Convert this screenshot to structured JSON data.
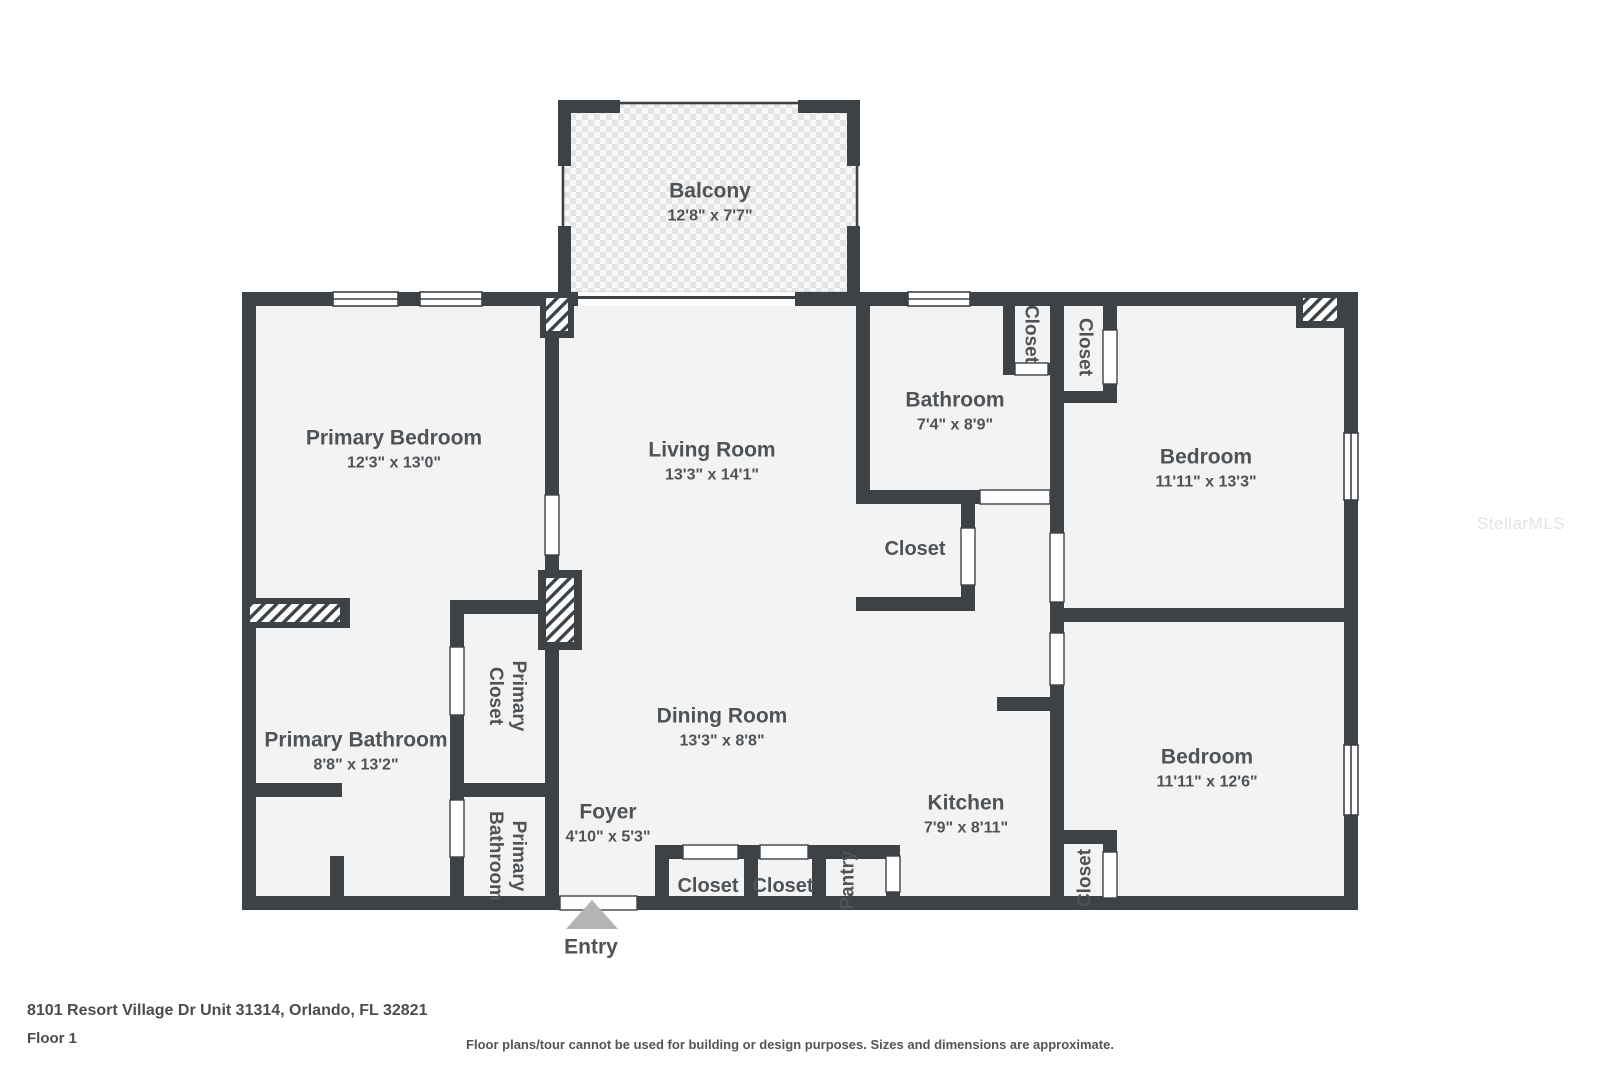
{
  "page": {
    "width": 1600,
    "height": 1066,
    "background": "#ffffff"
  },
  "watermark": "StellarMLS",
  "footer": {
    "address": "8101 Resort Village Dr Unit 31314, Orlando, FL 32821",
    "floor": "Floor 1",
    "disclaimer": "Floor plans/tour cannot be used for building or design purposes. Sizes and dimensions are approximate."
  },
  "colors": {
    "wall": "#3d4247",
    "room_fill": "#f3f3f3",
    "label_text": "#4e5358",
    "entry_marker": "#b4b4b4",
    "balcony_tile": "#e4e4e4",
    "watermark_text": "#e3e3e6"
  },
  "rooms": {
    "balcony": {
      "name": "Balcony",
      "dims": "12'8\" x 7'7\""
    },
    "primary_bedroom": {
      "name": "Primary Bedroom",
      "dims": "12'3\" x 13'0\""
    },
    "living_room": {
      "name": "Living Room",
      "dims": "13'3\" x 14'1\""
    },
    "bathroom": {
      "name": "Bathroom",
      "dims": "7'4\" x 8'9\""
    },
    "bedroom_top": {
      "name": "Bedroom",
      "dims": "11'11\" x 13'3\""
    },
    "bedroom_bottom": {
      "name": "Bedroom",
      "dims": "11'11\" x 12'6\""
    },
    "dining_room": {
      "name": "Dining Room",
      "dims": "13'3\" x 8'8\""
    },
    "primary_bathroom": {
      "name": "Primary Bathroom",
      "dims": "8'8\" x 13'2\""
    },
    "kitchen": {
      "name": "Kitchen",
      "dims": "7'9\" x 8'11\""
    },
    "foyer": {
      "name": "Foyer",
      "dims": "4'10\" x 5'3\""
    },
    "primary_closet": {
      "lines": [
        "Primary",
        "Closet"
      ]
    },
    "primary_bathroom_small": {
      "lines": [
        "Primary",
        "Bathroom"
      ]
    },
    "closet_bathroom_1": {
      "name": "Closet"
    },
    "closet_bathroom_2": {
      "name": "Closet"
    },
    "closet_hall": {
      "name": "Closet"
    },
    "closet_foyer_1": {
      "name": "Closet"
    },
    "closet_foyer_2": {
      "name": "Closet"
    },
    "pantry": {
      "name": "Pantry"
    },
    "closet_bedroom": {
      "name": "Closet"
    },
    "entry": {
      "name": "Entry"
    }
  }
}
